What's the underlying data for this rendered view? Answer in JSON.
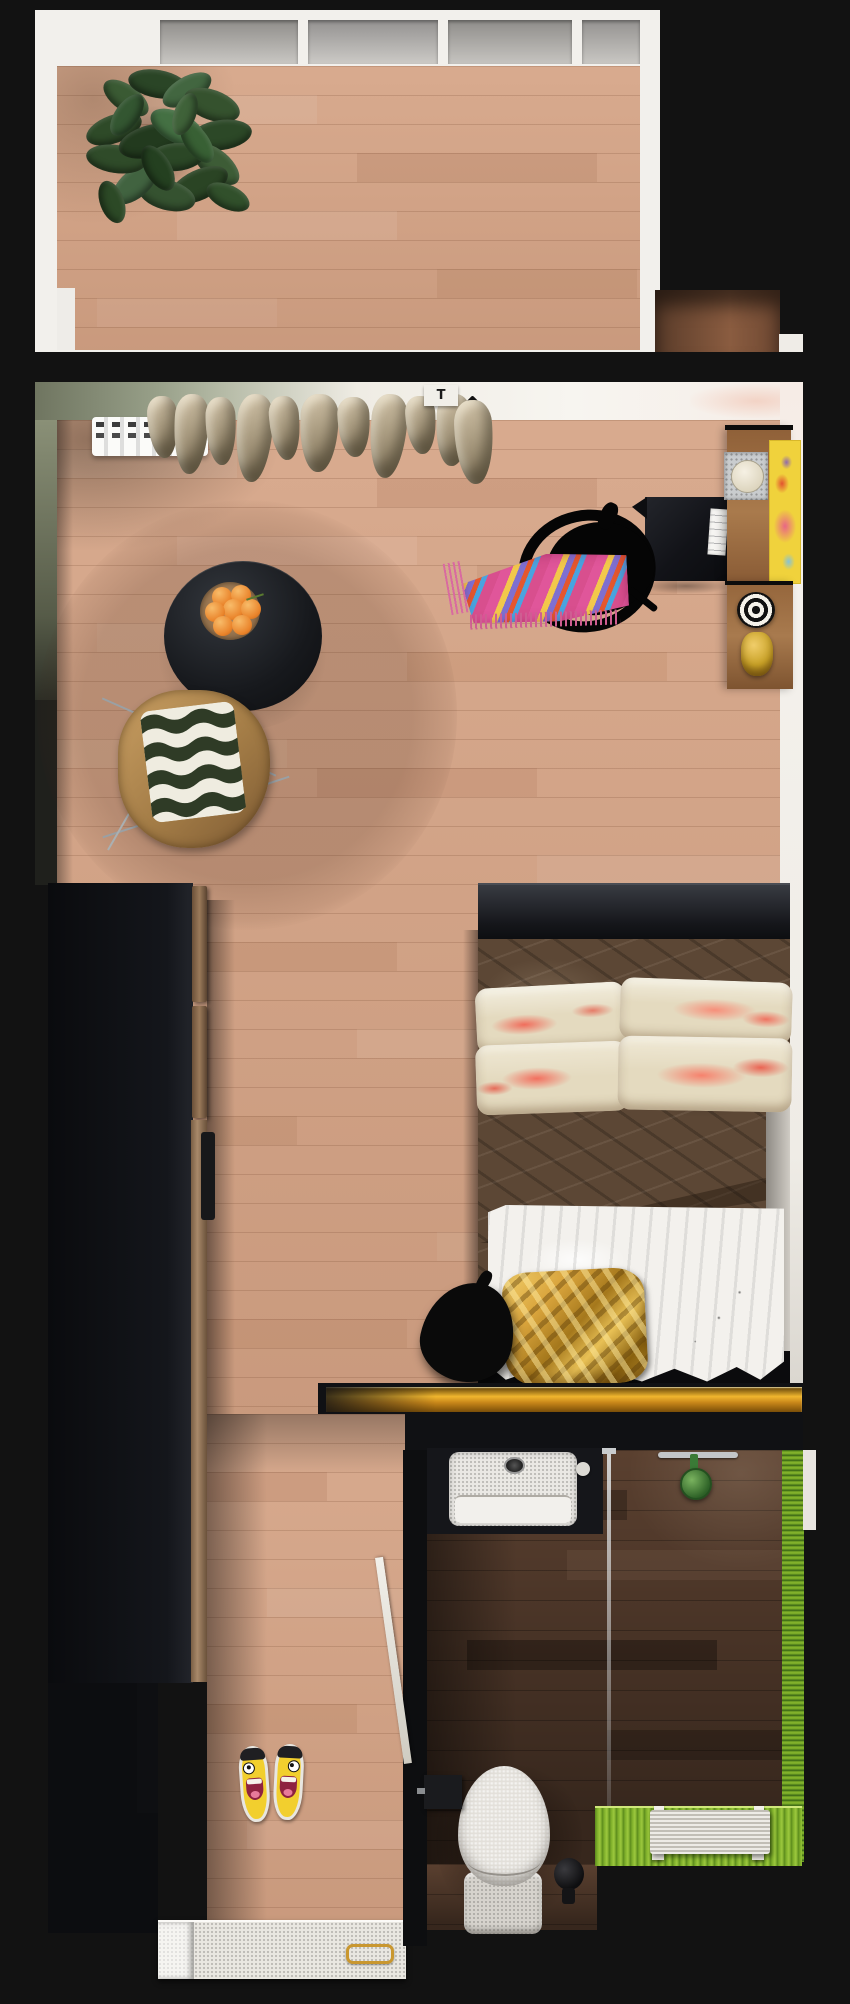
{
  "meta": {
    "view": "apartment-3d-top-view",
    "canvas_width": 850,
    "canvas_height": 2004
  },
  "thermostat": {
    "label": "T"
  },
  "rooms": [
    {
      "id": "balcony",
      "label": "Balcony"
    },
    {
      "id": "living-bedroom",
      "label": "Living / Bedroom"
    },
    {
      "id": "hallway",
      "label": "Hallway"
    },
    {
      "id": "bathroom",
      "label": "Bathroom"
    }
  ],
  "palette": {
    "background": "#121212",
    "floor_wood": "#d4a284",
    "bathroom_floor": "#6e4e3a",
    "wall_white": "#f2efe9",
    "wall_sage": "#8a9077",
    "wardrobe_black": "#0d0e12",
    "bronze_trim": "#9a7a5a",
    "curtain_beige": "#b4a68c",
    "table_black": "#17191d",
    "fruit_orange": "#ea852c",
    "rattan_tan": "#c9a263",
    "cushion_wave_green": "#2f3b26",
    "poster_yellow": "#f0d23c",
    "blanket_pink": "#e0569a",
    "duvet_brown": "#5c4735",
    "pillow_marble_pink": "#f0796b",
    "sheet_white": "#f3f1ed",
    "gold_pillow": "#d9a43c",
    "gold_trim": "#e0a62e",
    "mosaic_green": "#86b62e",
    "shower_green": "#3f7d36",
    "porcelain": "#e3e0da",
    "terrazzo": "#e9e7e1",
    "flipflop_yellow": "#f2cf2e",
    "leaf_green": "#2e4a28"
  },
  "items": [
    {
      "id": "potted-plant",
      "label": "Potted plant",
      "room": "balcony"
    },
    {
      "id": "balcony-windows",
      "label": "Window band",
      "room": "balcony",
      "count": 4
    },
    {
      "id": "radiator",
      "label": "Radiator",
      "room": "living-bedroom"
    },
    {
      "id": "curtains",
      "label": "Beige curtains",
      "room": "living-bedroom"
    },
    {
      "id": "thermostat-box",
      "label": "Curtain bracket box",
      "room": "living-bedroom"
    },
    {
      "id": "coffee-table",
      "label": "Round black table",
      "room": "living-bedroom"
    },
    {
      "id": "fruit-plate",
      "label": "Wooden plate with oranges",
      "oranges": 7
    },
    {
      "id": "rattan-chair",
      "label": "Rattan chair with wave cushion"
    },
    {
      "id": "desk",
      "label": "Black desk"
    },
    {
      "id": "office-chair",
      "label": "Black office chair"
    },
    {
      "id": "boho-blanket",
      "label": "Multicolor fringe blanket"
    },
    {
      "id": "shelf-upper",
      "label": "Wall shelf with art frame"
    },
    {
      "id": "poster",
      "label": "Yellow poster"
    },
    {
      "id": "shelf-lower",
      "label": "Wall shelf with decor"
    },
    {
      "id": "bullseye-decor",
      "label": "Black & white circles decor"
    },
    {
      "id": "gold-figurine",
      "label": "Gold figurine"
    },
    {
      "id": "wardrobe",
      "label": "Black wardrobe"
    },
    {
      "id": "bed",
      "label": "Double bed"
    },
    {
      "id": "gold-pillow",
      "label": "Gold crumpled pillow"
    },
    {
      "id": "bean-lamp",
      "label": "Black teardrop floor lamp"
    },
    {
      "id": "glass-wall-gold-edge",
      "label": "Bathroom glass wall gold edge"
    },
    {
      "id": "bathroom-door",
      "label": "White door (ajar)"
    },
    {
      "id": "sink-vanity",
      "label": "Vanity with stone basin"
    },
    {
      "id": "shower-glass",
      "label": "Glass shower panel"
    },
    {
      "id": "towel-bar",
      "label": "Chrome towel bar"
    },
    {
      "id": "shower-head",
      "label": "Green shower head"
    },
    {
      "id": "toilet",
      "label": "Toilet"
    },
    {
      "id": "toilet-brush",
      "label": "Toilet brush"
    },
    {
      "id": "paper-holder",
      "label": "Toilet paper holder"
    },
    {
      "id": "mosaic-strip",
      "label": "Green mosaic wall & floor"
    },
    {
      "id": "shower-bench",
      "label": "White slatted bench"
    },
    {
      "id": "flip-flops",
      "label": "Smiley flip-flops",
      "count": 2
    },
    {
      "id": "terrazzo-step",
      "label": "Terrazzo step with gold handle"
    }
  ]
}
